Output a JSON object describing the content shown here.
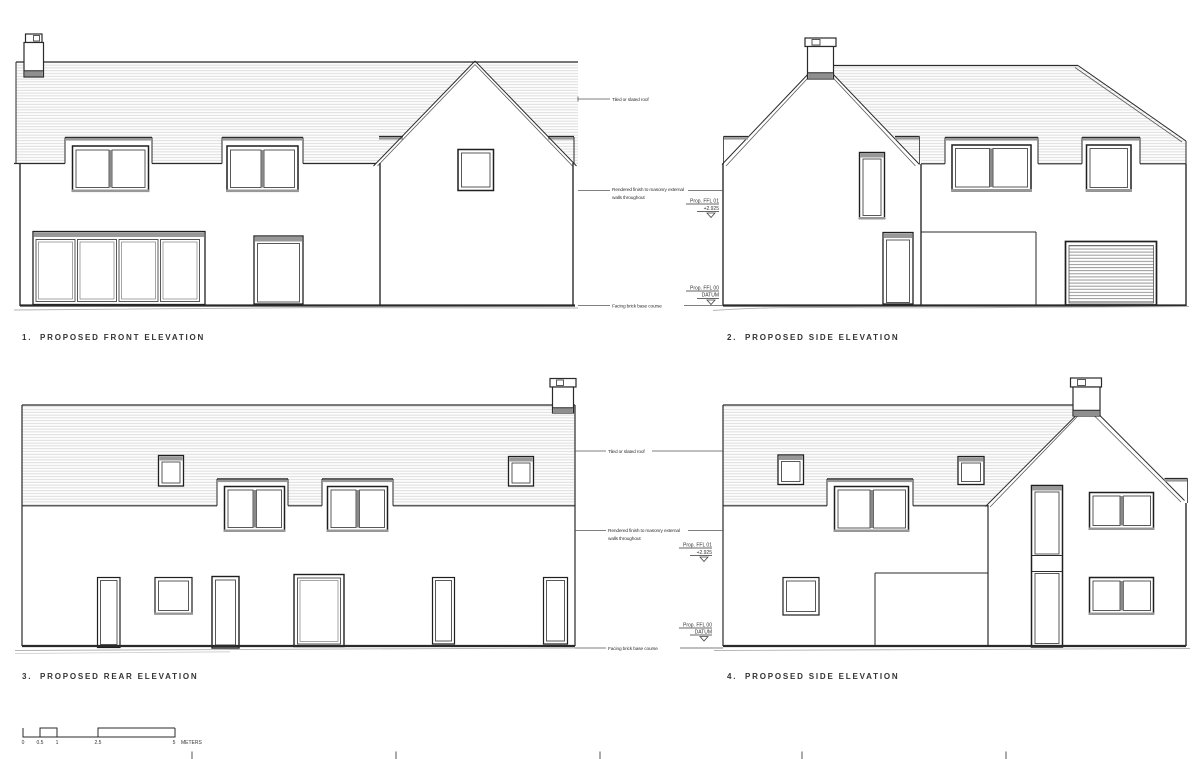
{
  "sheet": {
    "background": "#ffffff"
  },
  "elevations": [
    {
      "num": "1.",
      "title": "PROPOSED FRONT ELEVATION"
    },
    {
      "num": "2.",
      "title": "PROPOSED SIDE ELEVATION"
    },
    {
      "num": "3.",
      "title": "PROPOSED REAR ELEVATION"
    },
    {
      "num": "4.",
      "title": "PROPOSED SIDE ELEVATION"
    }
  ],
  "annotations": {
    "roof": "Tiled or slated roof",
    "walls_line1": "Rendered finish to masonry external",
    "walls_line2": "walls throughout",
    "base": "Facing brick base course",
    "ffl01_label": "Prop. FFL 01",
    "ffl01_value": "+2.925",
    "ffl00_label": "Prop. FFL 00",
    "ffl00_value": "DATUM"
  },
  "scale_bar": {
    "labels": [
      "0",
      "0.5",
      "1",
      "2.5",
      "5"
    ],
    "unit": "METERS"
  },
  "colors": {
    "line": "#2a2a2a",
    "band_gray": "#989898",
    "roof_hatch_line": "#d2d2d2"
  }
}
